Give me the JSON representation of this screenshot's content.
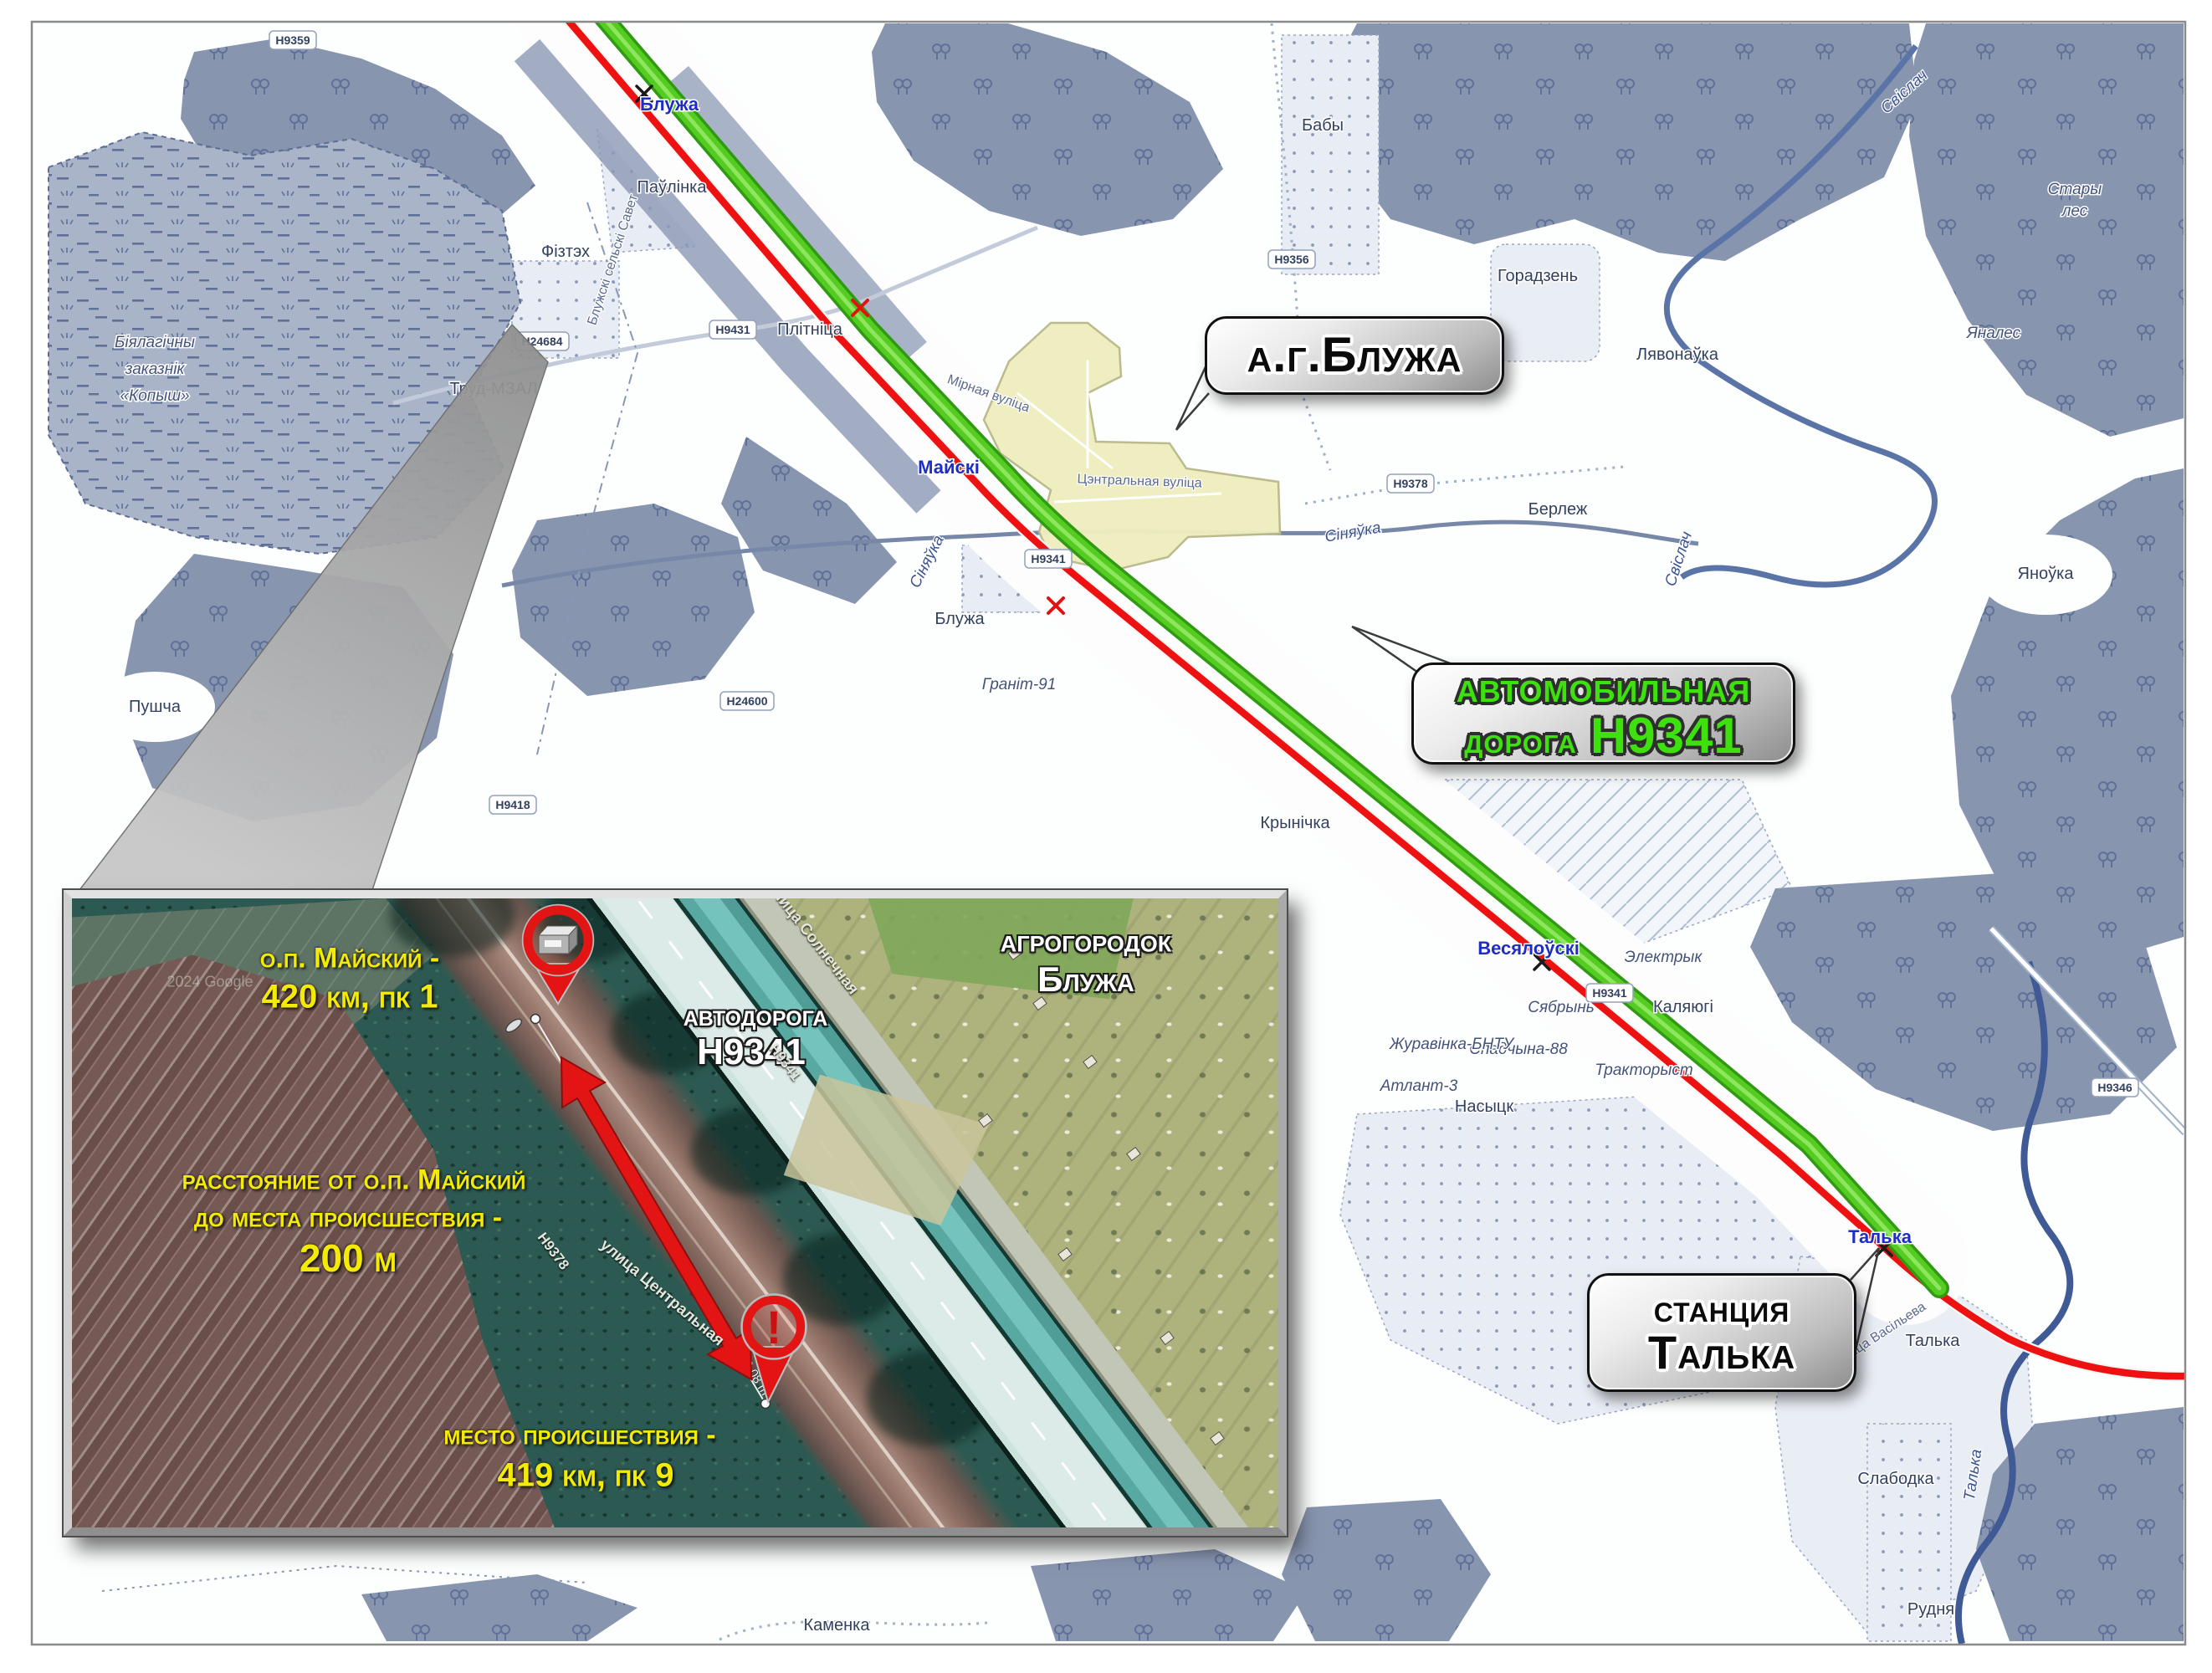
{
  "callouts": {
    "settlement": "а.г.Блужа",
    "road_line1": "автомобильная",
    "road_line2a": "дорога",
    "road_line2b": "Н9341",
    "station_line1": "станция",
    "station_line2": "Талька"
  },
  "colors": {
    "railway_red": "#ee1111",
    "road_green": "#55cc22",
    "forest_blue_gray": "#8895af",
    "callout_green_text": "#3ee00e",
    "inset_label_yellow": "#f4ea07",
    "pin_red": "#e31414"
  },
  "map": {
    "stations": {
      "bluzha": "Блужа",
      "mayski": "Майскі",
      "vesyalowski": "Весялоўскі",
      "talka": "Талька"
    },
    "reserve": {
      "l1": "Біялагічны",
      "l2": "заказнік",
      "l3": "«Копыш»"
    },
    "places": {
      "pawlinka": "Паўлінка",
      "fiztekh": "Фізтэх",
      "plitnitsa": "Плітніца",
      "trud": "Труд-МЗАЛ",
      "baby": "Бабы",
      "goradzen": "Горадзень",
      "lyavonawka": "Лявонаўка",
      "yanales": "Яналес",
      "stary1": "Стары",
      "stary2": "лес",
      "yanowka": "Яноўка",
      "berlezh": "Берлеж",
      "bluzha_v": "Блужа",
      "granit": "Граніт-91",
      "krynichka": "Крынічка",
      "elektryk": "Электрык",
      "kalyugi": "Каляюгі",
      "syabryn": "Сябрынь",
      "spadchyna": "Спадчына-88",
      "traktoryst": "Тракторыст",
      "nasyck": "Насыцк",
      "atlant": "Атлант-3",
      "zhuravinka": "Журавінка-БНТУ",
      "kamenka": "Каменка",
      "slabodka": "Слабодка",
      "rudnya": "Рудня",
      "talka_v": "Талька",
      "pushcha": "Пушча"
    },
    "streets": {
      "mirnaya": "Мірная вуліца",
      "central": "Цэнтральная вуліца",
      "vasileva": "вуліца Васільева",
      "selsavet": "Блужскі сельскі Савет"
    },
    "rivers": {
      "svisloch1": "Свіслач",
      "svisloch2": "Свіслач",
      "sinyawka1": "Сіняўка",
      "sinyawka2": "Сіняўка",
      "talka_r": "Талька"
    },
    "badges": {
      "b9359": "Н9359",
      "b24684": "Н24684",
      "b9431": "Н9431",
      "b9356": "Н9356",
      "b9378": "Н9378",
      "b24600": "Н24600",
      "b9418": "Н9418",
      "b9341": "Н9341",
      "b9346": "Н9346"
    }
  },
  "inset": {
    "op_line1": "о.п. Майский -",
    "op_line2": "420 км, пк 1",
    "dist_line1": "расстояние от о.п. Майский",
    "dist_line2": "до места происшествия -",
    "dist_line3": "200 м",
    "incident_line1": "место происшествия -",
    "incident_line2": "419 км, пк 9",
    "road_line1": "автодорога",
    "road_line2": "Н9341",
    "agro_line1": "агрогородок",
    "agro_line2": "Блужа",
    "street_sun": "улица Солнечная",
    "street_cen": "улица Центральная",
    "road_small_9378": "Н9378",
    "road_small_9341": "Н9341",
    "measure": "9,08 m",
    "watermark": "2024 Google",
    "exclam": "!"
  }
}
